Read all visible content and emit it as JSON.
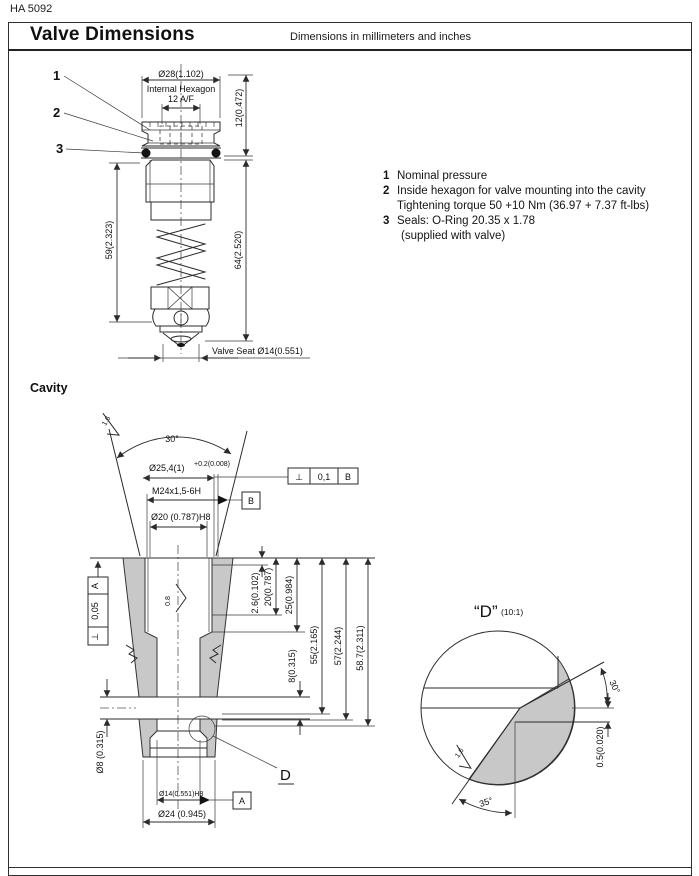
{
  "page": {
    "doc_code": "HA 5092",
    "title": "Valve Dimensions",
    "subtitle": "Dimensions in millimeters and inches"
  },
  "notes": [
    {
      "num": "1",
      "line1": "Nominal pressure",
      "line2": ""
    },
    {
      "num": "2",
      "line1": "Inside hexagon for valve mounting into the cavity",
      "line2": "Tightening torque 50 +10 Nm (36.97 + 7.37 ft-lbs)"
    },
    {
      "num": "3",
      "line1": "Seals: O-Ring 20.35 x 1.78",
      "line2": "(supplied with valve)"
    }
  ],
  "valve": {
    "callout1": "1",
    "callout2": "2",
    "callout3": "3",
    "dia28": "Ø28(1.102)",
    "hex_label1": "Internal Hexagon",
    "hex_label2": "12 A/F",
    "h12": "12(0.472)",
    "h59": "59(2.323)",
    "h64": "64(2.520)",
    "seat": "Valve Seat Ø14(0.551)"
  },
  "cavity": {
    "label": "Cavity",
    "deg30": "30°",
    "dia254_main": "Ø25,4(1)",
    "dia254_sup": "+0.2(0.008)",
    "m24": "M24x1,5-6H",
    "dia20": "Ø20 (0.787)H8",
    "d26": "2.6(0.102)",
    "d20": "20(0.787)",
    "d25": "25(0.984)",
    "d8": "8(0.315)",
    "d55": "55(2.165)",
    "d57": "57(2.244)",
    "d587": "58.7(2.311)",
    "dia8": "Ø8 (0.315)",
    "dia14": "Ø14(0.551)H8",
    "dia24": "Ø24 (0.945)",
    "detail_ref": "D",
    "rough16": "1.6",
    "rough08": "0.8",
    "frame1_sym": "⊥",
    "frame1_tol": "0,1",
    "frame1_datum": "B",
    "frame2_sym": "⊥",
    "frame2_tol": "0,05",
    "frame2_datum": "A",
    "datum_a": "A",
    "datum_b": "B"
  },
  "detail": {
    "title": "“D”",
    "scale": "(10:1)",
    "deg30": "30°",
    "deg35": "35°",
    "h05": "0.5(0.020)",
    "rough16": "1.6"
  },
  "colors": {
    "line": "#2b2b2b",
    "fill_gray": "#c8c8c8"
  }
}
